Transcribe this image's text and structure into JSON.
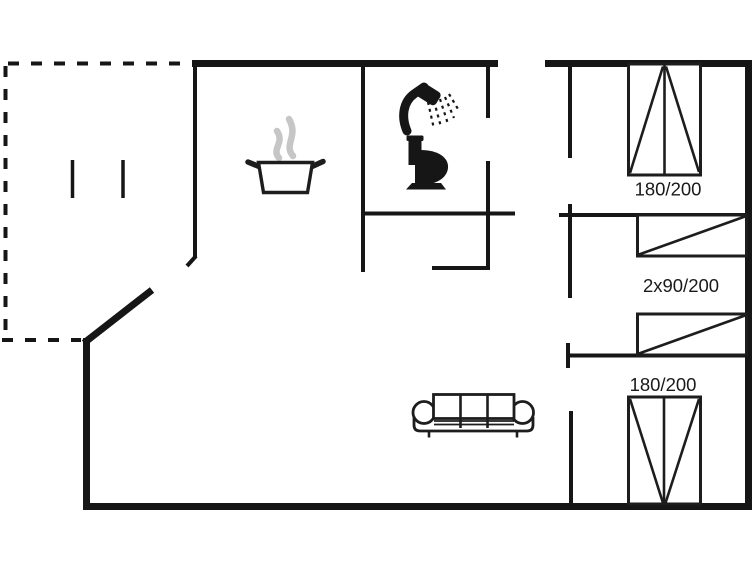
{
  "floor_plan": {
    "labels": {
      "bed_top": "180/200",
      "bunk_beds": "2x90/200",
      "bed_bottom": "180/200"
    },
    "colors": {
      "wall": "#161616",
      "label_text": "#1a1a1a",
      "steam": "#c6c6c6",
      "background": "#ffffff"
    },
    "icons": [
      "cooking-pot-icon",
      "steam-icon",
      "shower-icon",
      "toilet-icon",
      "sofa-icon",
      "double-bed-icon",
      "bunk-bed-icon",
      "double-bed-icon"
    ]
  }
}
